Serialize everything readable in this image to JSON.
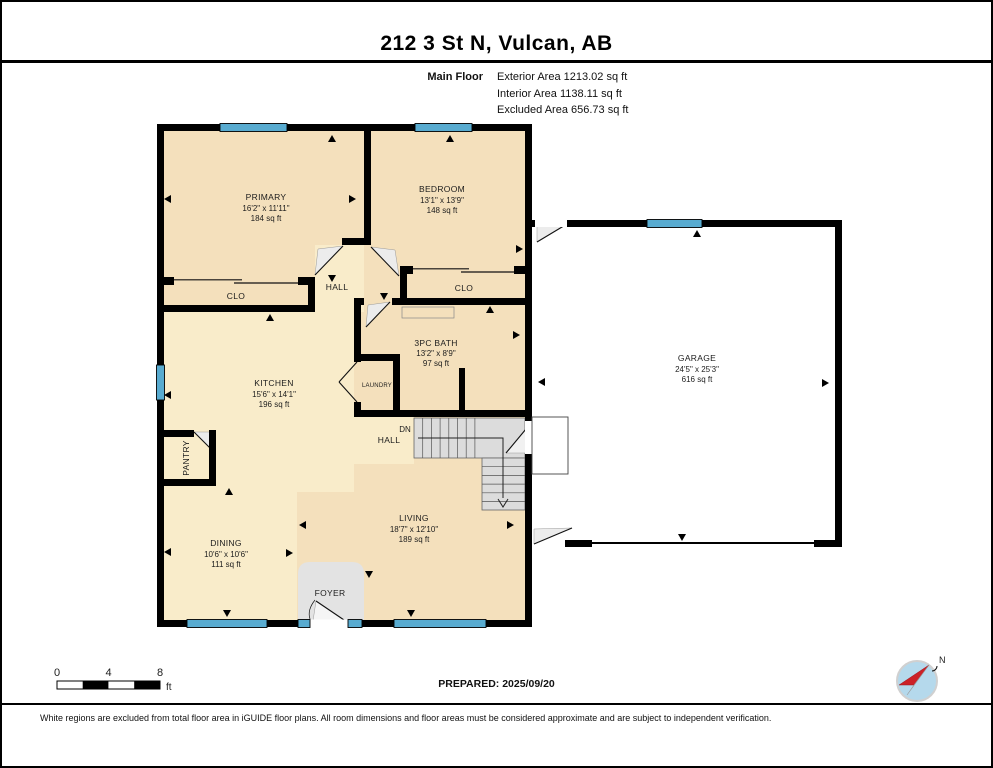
{
  "page": {
    "title": "212 3 St N, Vulcan, AB"
  },
  "floor_info": {
    "label": "Main Floor",
    "exterior": "Exterior Area 1213.02 sq ft",
    "interior": "Interior Area 1138.11 sq ft",
    "excluded": "Excluded Area 656.73 sq ft"
  },
  "rooms": {
    "primary": {
      "name": "PRIMARY",
      "dims": "16'2\" x 11'11\"",
      "area": "184 sq ft"
    },
    "bedroom": {
      "name": "BEDROOM",
      "dims": "13'1\" x 13'9\"",
      "area": "148 sq ft"
    },
    "bath": {
      "name": "3PC BATH",
      "dims": "13'2\" x 8'9\"",
      "area": "97 sq ft"
    },
    "kitchen": {
      "name": "KITCHEN",
      "dims": "15'6\" x 14'1\"",
      "area": "196 sq ft"
    },
    "living": {
      "name": "LIVING",
      "dims": "18'7\" x 12'10\"",
      "area": "189 sq ft"
    },
    "dining": {
      "name": "DINING",
      "dims": "10'6\" x 10'6\"",
      "area": "111 sq ft"
    },
    "garage": {
      "name": "GARAGE",
      "dims": "24'5\" x 25'3\"",
      "area": "616 sq ft"
    }
  },
  "labels": {
    "hall_upper": "HALL",
    "hall_lower": "HALL",
    "dn": "DN",
    "closet_primary": "CLO",
    "closet_bedroom": "CLO",
    "laundry": "LAUNDRY",
    "pantry": "PANTRY",
    "foyer": "FOYER"
  },
  "scale_bar": {
    "t0": "0",
    "t4": "4",
    "t8": "8",
    "unit": "ft"
  },
  "compass": {
    "north_label": "N"
  },
  "footer": {
    "prepared": "PREPARED: 2025/09/20",
    "disclaimer": "White regions are excluded from total floor area in iGUIDE floor plans. All room dimensions and floor areas must be considered approximate and are subject to independent verification."
  },
  "colors": {
    "wall": "#000000",
    "window": "#58abd0",
    "room_tan": "#f4e0bc",
    "room_cream": "#f9ecca",
    "foyer_grey": "#e3e3e3",
    "stairs_grey": "#dcdcdc",
    "compass_blue": "#b5d9ec",
    "compass_red": "#cc2127"
  }
}
